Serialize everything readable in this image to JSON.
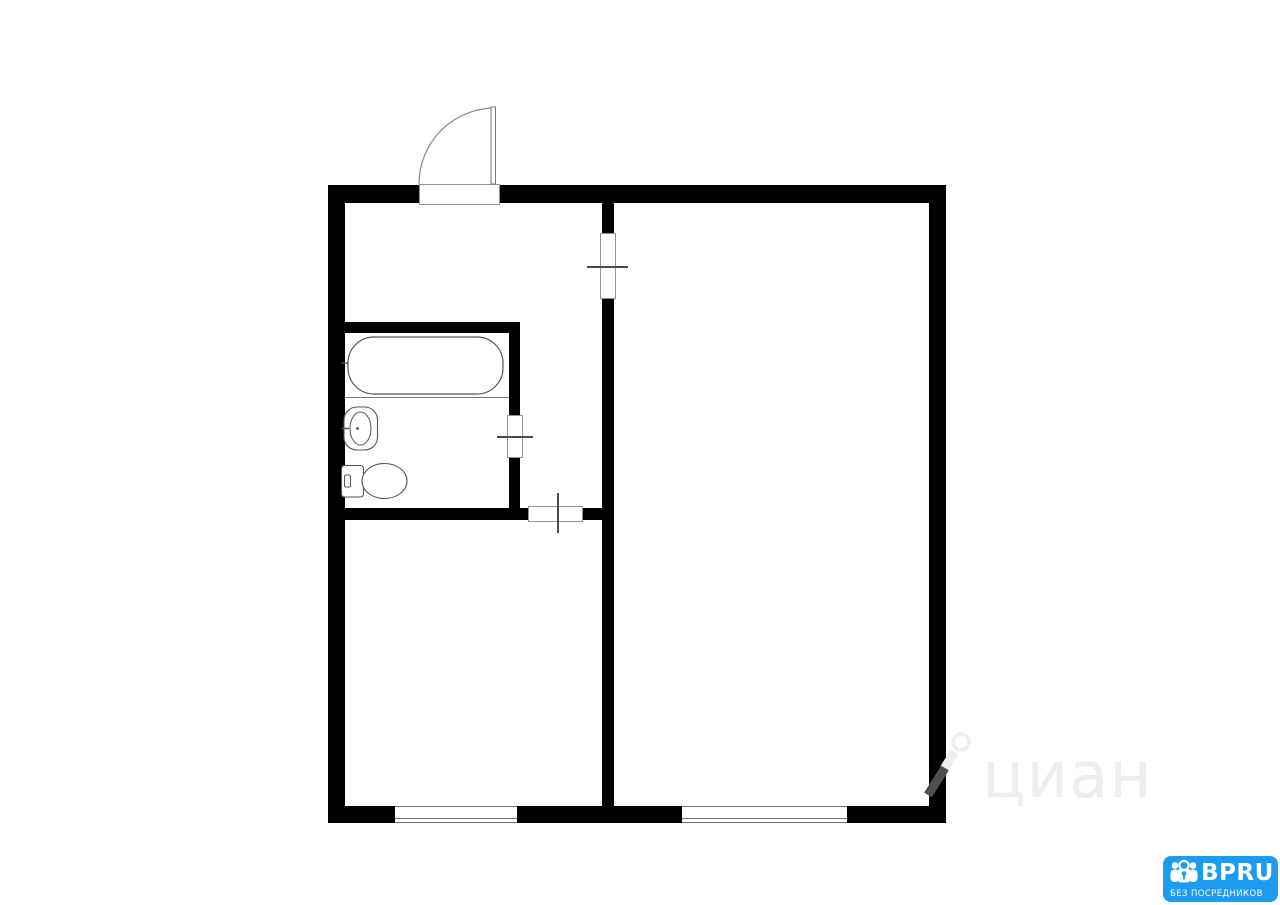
{
  "page": {
    "width": 1280,
    "height": 905,
    "background": "#ffffff"
  },
  "floor_plan": {
    "type": "apartment-floor-plan",
    "wall_color": "#000000",
    "rooms": [
      "hall",
      "bathroom",
      "kitchen",
      "living-room"
    ],
    "walls": [
      {
        "x": 328,
        "y": 185,
        "w": 91,
        "h": 18
      },
      {
        "x": 500,
        "y": 185,
        "w": 446,
        "h": 18
      },
      {
        "x": 328,
        "y": 185,
        "w": 17,
        "h": 638
      },
      {
        "x": 929,
        "y": 185,
        "w": 17,
        "h": 638
      },
      {
        "x": 328,
        "y": 806,
        "w": 67,
        "h": 17
      },
      {
        "x": 517,
        "y": 806,
        "w": 165,
        "h": 17
      },
      {
        "x": 847,
        "y": 806,
        "w": 99,
        "h": 17
      },
      {
        "x": 602,
        "y": 203,
        "w": 12,
        "h": 30
      },
      {
        "x": 602,
        "y": 299,
        "w": 12,
        "h": 507
      },
      {
        "x": 345,
        "y": 322,
        "w": 175,
        "h": 11
      },
      {
        "x": 509,
        "y": 333,
        "w": 11,
        "h": 82
      },
      {
        "x": 509,
        "y": 458,
        "w": 11,
        "h": 50
      },
      {
        "x": 345,
        "y": 508,
        "w": 183,
        "h": 12
      },
      {
        "x": 583,
        "y": 508,
        "w": 19,
        "h": 12
      }
    ],
    "windows": [
      {
        "x": 395,
        "y": 806,
        "w": 122,
        "h": 17
      },
      {
        "x": 682,
        "y": 806,
        "w": 165,
        "h": 17
      }
    ],
    "door_openings": [
      {
        "x": 419,
        "y": 184,
        "w": 81,
        "h": 21
      },
      {
        "x": 600,
        "y": 233,
        "w": 16,
        "h": 66
      },
      {
        "x": 507,
        "y": 415,
        "w": 16,
        "h": 43
      },
      {
        "x": 528,
        "y": 506,
        "w": 55,
        "h": 16
      }
    ],
    "door_ticks": [
      {
        "x": 587,
        "y": 266,
        "w": 41,
        "h": 2
      },
      {
        "x": 497,
        "y": 436,
        "w": 36,
        "h": 2
      },
      {
        "x": 557,
        "y": 493,
        "w": 2,
        "h": 40
      }
    ]
  },
  "watermark": {
    "text": "циан",
    "text_color": "#ededed",
    "pin_color": "#ededed",
    "pin_on_wall_color": "#4f4f4f"
  },
  "logo": {
    "title": "BPRU",
    "subtitle": "БЕЗ ПОСРЕДНИКОВ",
    "background": "#1b9bf1",
    "text_color": "#ffffff"
  }
}
